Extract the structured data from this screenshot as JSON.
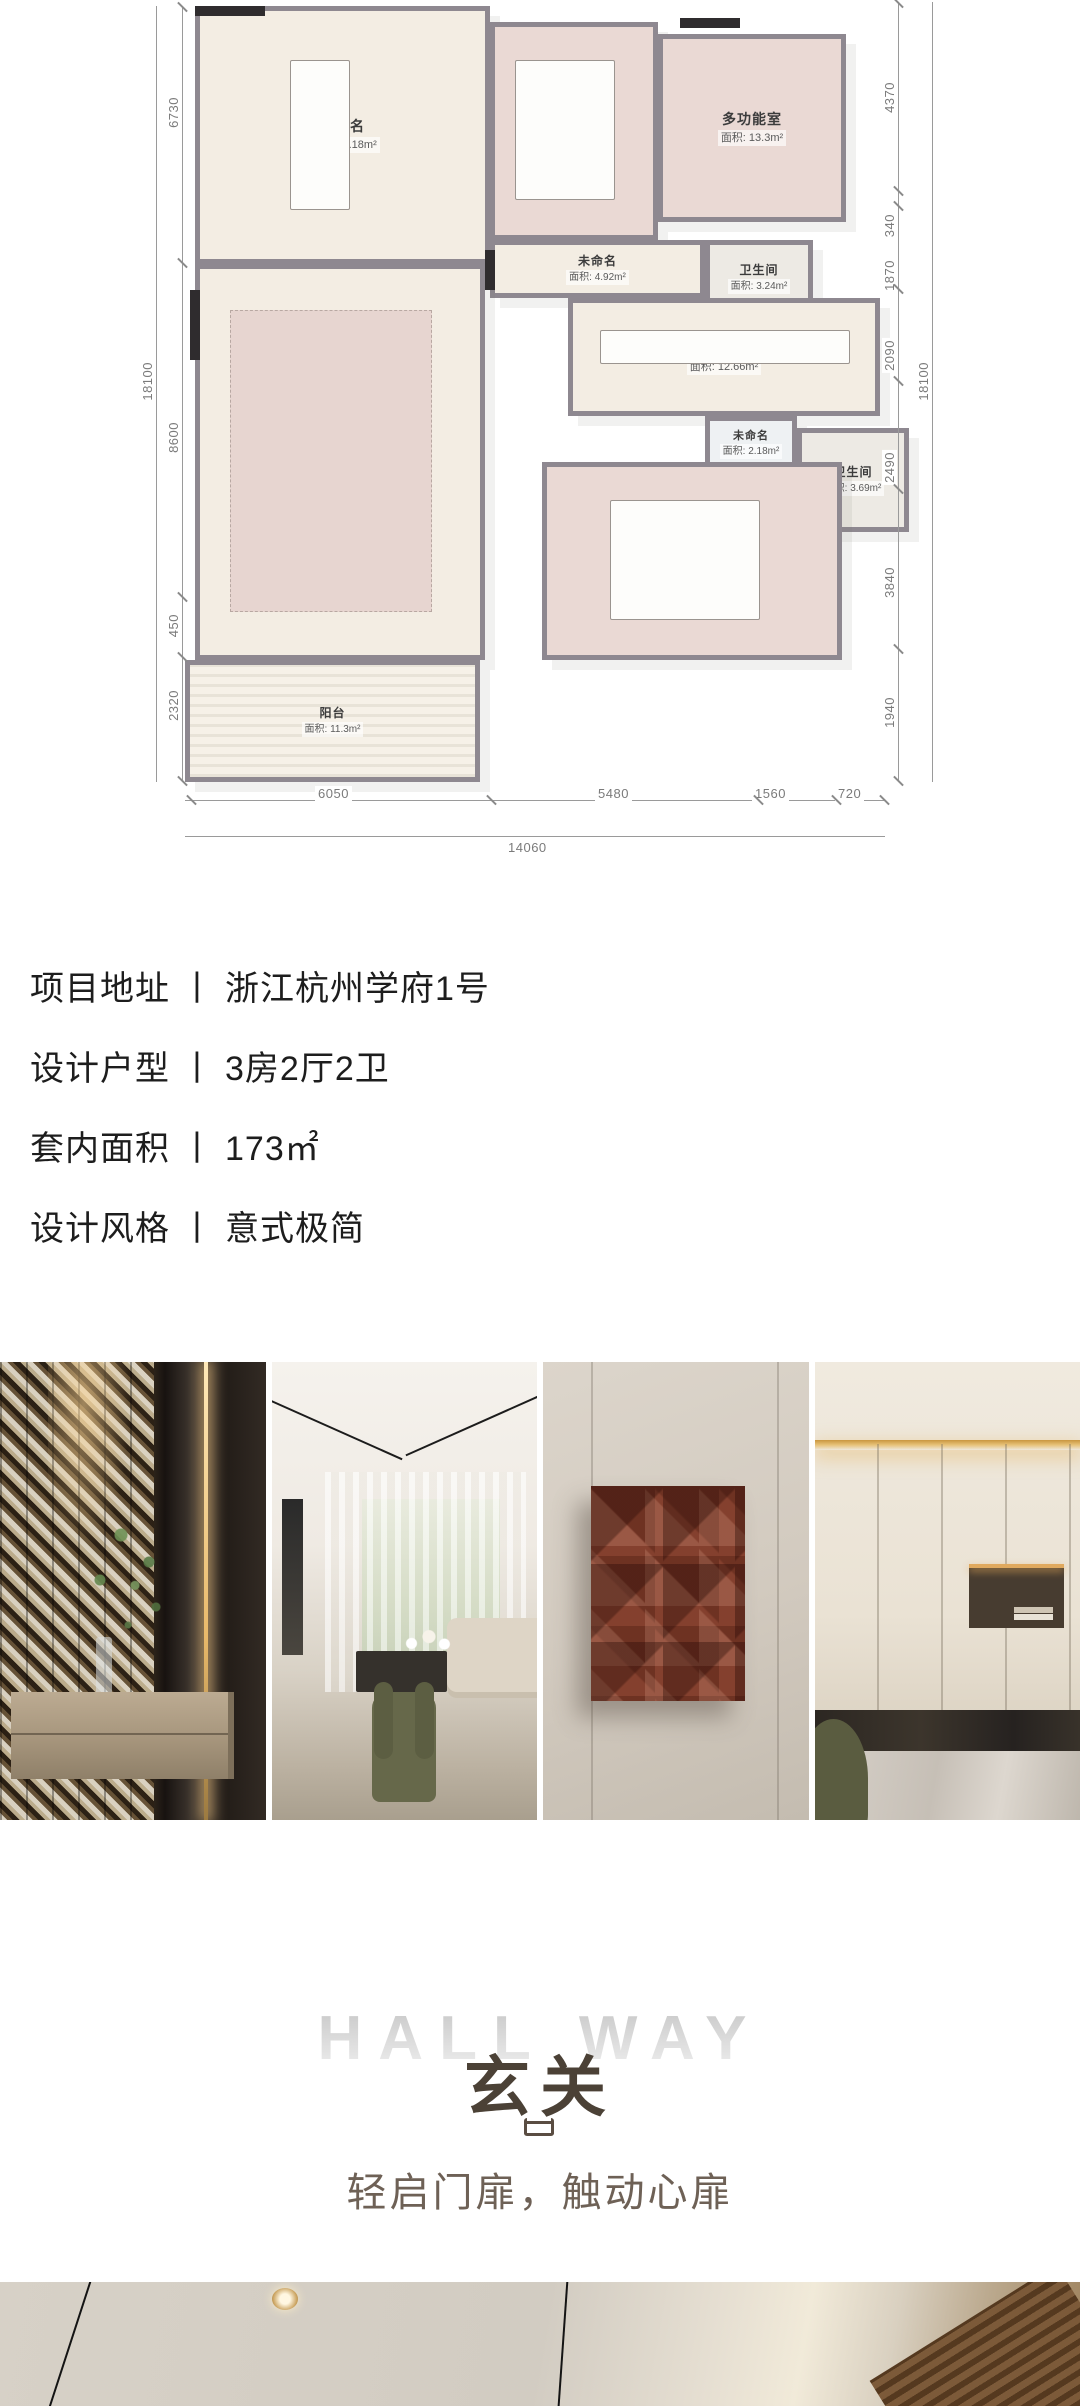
{
  "floor_plan": {
    "rooms": [
      {
        "name": "未命名",
        "area": "面积: 28.18m²"
      },
      {
        "name": "卧室",
        "area": "面积: 10.06m²"
      },
      {
        "name": "多功能室",
        "area": "面积: 13.3m²"
      },
      {
        "name": "未命名",
        "area": "面积: 4.92m²"
      },
      {
        "name": "卫生间",
        "area": "面积: 3.24m²"
      },
      {
        "name": "步入式衣柜",
        "area": "面积: 12.66m²"
      },
      {
        "name": "未命名",
        "area": "面积: 2.18m²"
      },
      {
        "name": "卫生间",
        "area": "面积: 3.69m²"
      },
      {
        "name": "客厅",
        "area": "面积: 51.14m²"
      },
      {
        "name": "主卧",
        "area": "面积: 22.6m²"
      },
      {
        "name": "阳台",
        "area": "面积: 11.3m²"
      }
    ],
    "dims_left": [
      "6730",
      "8600",
      "450",
      "2320"
    ],
    "dims_left_total": "18100",
    "dims_right": [
      "4370",
      "340",
      "1870",
      "2090",
      "2490",
      "3840",
      "1940"
    ],
    "dims_right_total": "18100",
    "dims_bottom": [
      "6050",
      "5480",
      "1560",
      "720"
    ],
    "dims_bottom_total": "14060"
  },
  "project_info": {
    "items": [
      {
        "label": "项目地址",
        "sep": "丨",
        "value": "浙江杭州学府1号"
      },
      {
        "label": "设计户型",
        "sep": "丨",
        "value": "3房2厅2卫"
      },
      {
        "label": "套内面积",
        "sep": "丨",
        "value": "173㎡"
      },
      {
        "label": "设计风格",
        "sep": "丨",
        "value": "意式极简"
      }
    ]
  },
  "gallery": {
    "photos": [
      {
        "icon": "entry-chevron-wall-photo"
      },
      {
        "icon": "living-room-photo"
      },
      {
        "icon": "terracotta-wall-art-photo"
      },
      {
        "icon": "cream-cabinet-wall-photo"
      }
    ]
  },
  "hallway_section": {
    "title_en": "HALL WAY",
    "title_cn": "玄关",
    "icon": "doorway-glyph",
    "tagline": "轻启门扉，触动心扉"
  },
  "colors": {
    "accent_brown": "#4b4136",
    "tagline_brown": "#6e6156",
    "faded_title_gray": "#d9d9d9",
    "plan_wall_gray": "#8e8890",
    "bedroom_pink": "#ead9d4",
    "floor_cream": "#f3ede3",
    "art_rust": "#84402e"
  }
}
